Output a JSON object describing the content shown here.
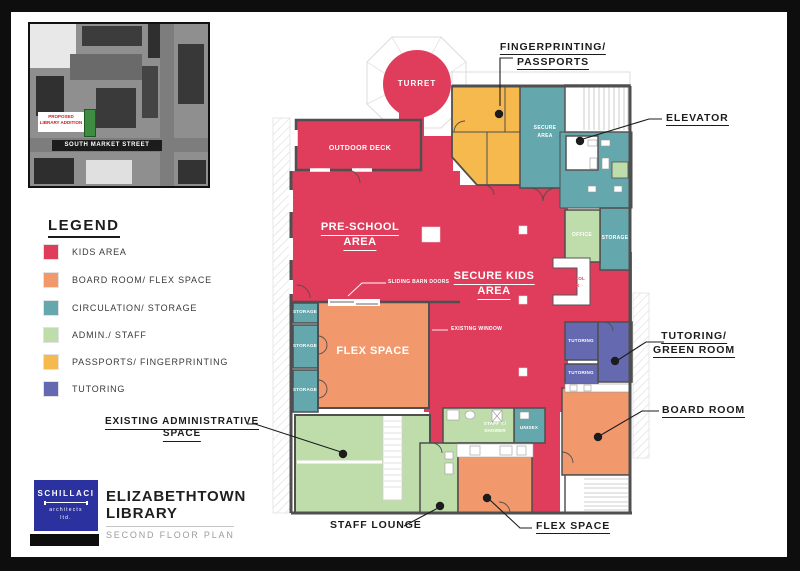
{
  "colors": {
    "kids_area": "#DF3D5B",
    "board_flex": "#F1996C",
    "circulation_storage": "#64A7AD",
    "admin_staff": "#BFDCAB",
    "passports_fingerprinting": "#F5B94E",
    "tutoring": "#6569B0",
    "logo_blue": "#2B32A0",
    "annotation": "#1C1C1C"
  },
  "site_map": {
    "proposed_addition_label": "PROPOSED LIBRARY ADDITION",
    "street_label": "SOUTH MARKET STREET"
  },
  "legend": {
    "title": "LEGEND",
    "items": [
      {
        "label": "KIDS AREA",
        "color": "#DF3D5B"
      },
      {
        "label": "BOARD ROOM/ FLEX SPACE",
        "color": "#F1996C"
      },
      {
        "label": "CIRCULATION/ STORAGE",
        "color": "#64A7AD"
      },
      {
        "label": "ADMIN./ STAFF",
        "color": "#BFDCAB"
      },
      {
        "label": "PASSPORTS/ FINGERPRINTING",
        "color": "#F5B94E"
      },
      {
        "label": "TUTORING",
        "color": "#6569B0"
      }
    ]
  },
  "plan": {
    "rooms": {
      "turret": "TURRET",
      "outdoor_deck": "OUTDOOR DECK",
      "preschool_line1": "PRE-SCHOOL",
      "preschool_line2": "AREA",
      "secure_kids_line1": "SECURE KIDS",
      "secure_kids_line2": "AREA",
      "secure_area_line1": "SECURE",
      "secure_area_line2": "AREA",
      "office": "OFFICE",
      "storage_right": "STORAGE",
      "control_desk_line1": "CONTROL",
      "control_desk_line2": "DESK",
      "tutoring_a": "TUTORING",
      "tutoring_b": "TUTORING",
      "flex_space": "FLEX SPACE",
      "storage_1": "STORAGE",
      "storage_2": "STORAGE",
      "storage_3": "STORAGE",
      "staff_toilet_line1": "STAFF T./",
      "staff_toilet_line2": "SHOWER",
      "unisex": "UNISEX"
    },
    "callouts": {
      "fingerprinting_line1": "FINGERPRINTING/",
      "fingerprinting_line2": "PASSPORTS",
      "elevator": "ELEVATOR",
      "tutoring_green_line1": "TUTORING/",
      "tutoring_green_line2": "GREEN ROOM",
      "board_room": "BOARD ROOM",
      "flex_space": "FLEX SPACE",
      "staff_lounge": "STAFF LOUNGE",
      "existing_admin_line1": "EXISTING ADMINISTRATIVE",
      "existing_admin_line2": "SPACE",
      "sliding_barn_doors": "SLIDING BARN DOORS",
      "existing_window": "EXISTING WINDOW"
    }
  },
  "titleblock": {
    "firm_name": "SCHILLACI",
    "firm_line2": "architects",
    "firm_line3": "ltd.",
    "project_line1": "ELIZABETHTOWN",
    "project_line2": "LIBRARY",
    "sheet_title": "SECOND FLOOR PLAN"
  }
}
